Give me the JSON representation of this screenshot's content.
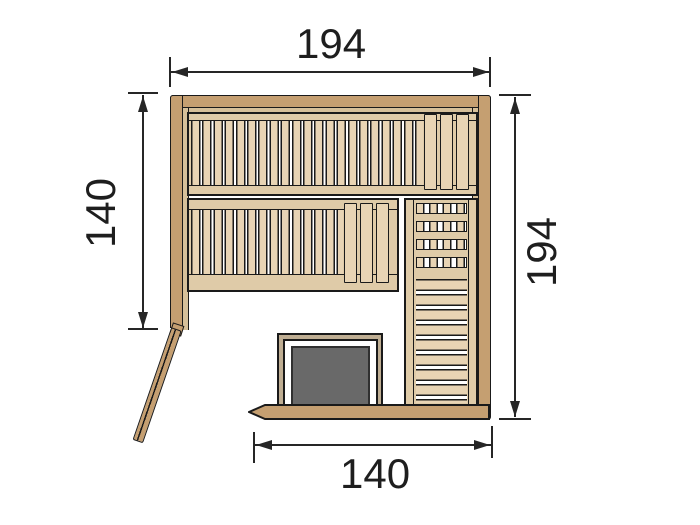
{
  "drawing": {
    "dimensions": {
      "top": "194",
      "left": "140",
      "right": "194",
      "bottom": "140"
    },
    "colors": {
      "wall": "#c59f71",
      "bench_slat": "#e8d4b4",
      "bench_rail": "#dfcba8",
      "liner": "#d6c09a",
      "outline": "#1a1a1a",
      "heater": "#696969",
      "heater_guard": "#bfae93",
      "dimension_lines": "#262626",
      "background": "#ffffff"
    }
  }
}
